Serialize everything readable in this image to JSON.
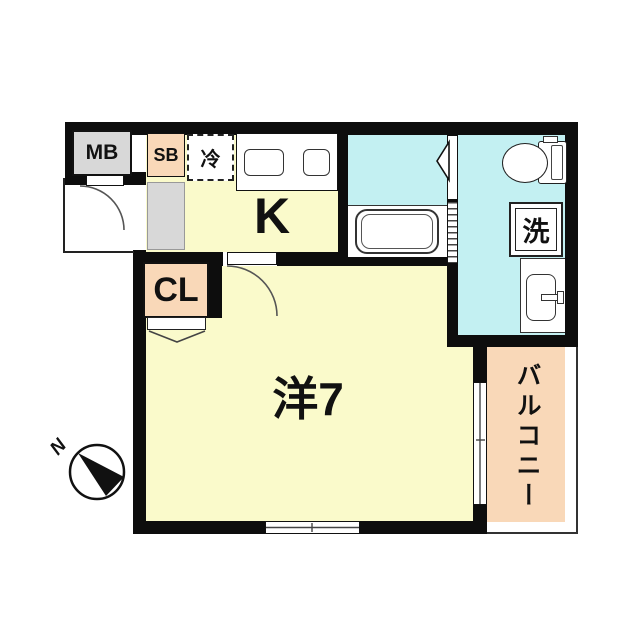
{
  "title": "apartment-floor-plan",
  "colors": {
    "room_floor_yellow": "#FAFACB",
    "wet_area_cyan": "#C3F0F2",
    "accent_peach": "#F9D8B8",
    "meter_gray": "#D8D8D8",
    "wall_black": "#0d0d0d"
  },
  "rooms": {
    "meter_box": {
      "label": "MB"
    },
    "shoe_box": {
      "label": "SB"
    },
    "refrigerator_space": {
      "label": "冷"
    },
    "kitchen": {
      "label": "K"
    },
    "closet": {
      "label": "CL"
    },
    "washing_machine": {
      "label": "洗"
    },
    "main_room": {
      "label": "洋7"
    },
    "balcony": {
      "label": "バルコニー"
    }
  },
  "compass": {
    "north_label": "N"
  }
}
